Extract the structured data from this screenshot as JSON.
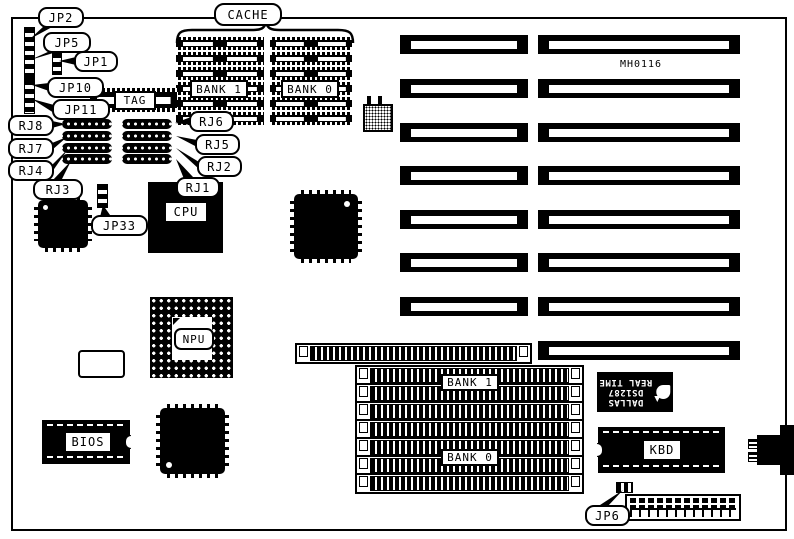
{
  "board": {
    "id_text": "MH0116"
  },
  "chips": {
    "cache_label": "CACHE",
    "tag": "TAG",
    "cache_bank1": "BANK 1",
    "cache_bank0": "BANK 0",
    "cpu": "CPU",
    "npu": "NPU",
    "bios": "BIOS",
    "kbd": "KBD",
    "simm_bank1": "BANK 1",
    "simm_bank0": "BANK 0",
    "rtc": {
      "brand": "DALLAS",
      "part": "DS1287",
      "function": "REAL TIME"
    }
  },
  "callouts": {
    "jp2": "JP2",
    "jp5": "JP5",
    "jp1": "JP1",
    "jp10": "JP10",
    "jp11": "JP11",
    "jp33": "JP33",
    "jp6": "JP6",
    "rj8": "RJ8",
    "rj7": "RJ7",
    "rj4": "RJ4",
    "rj3": "RJ3",
    "rj6": "RJ6",
    "rj5": "RJ5",
    "rj2": "RJ2",
    "rj1": "RJ1"
  },
  "colors": {
    "ink": "#000000",
    "paper": "#ffffff"
  }
}
